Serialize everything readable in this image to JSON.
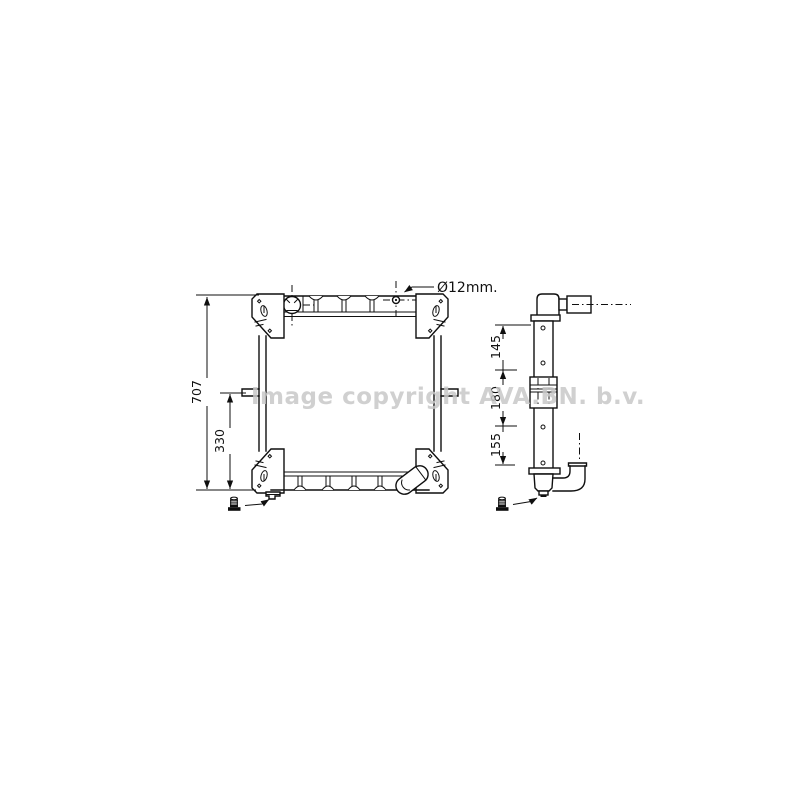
{
  "watermark": {
    "text": "Image copyright AVA.BN. b.v.",
    "color": "#c8c8c8"
  },
  "annotation": {
    "pipe_diameter_label": "Ø12mm."
  },
  "front_view": {
    "dimensions": {
      "overall_height_mm": "707",
      "lower_section_mm": "330"
    }
  },
  "side_view": {
    "dimensions": {
      "upper_mm": "145",
      "middle_mm": "180",
      "lower_mm": "155"
    }
  },
  "style": {
    "line_color": "#0f0f0f",
    "background": "#ffffff"
  }
}
